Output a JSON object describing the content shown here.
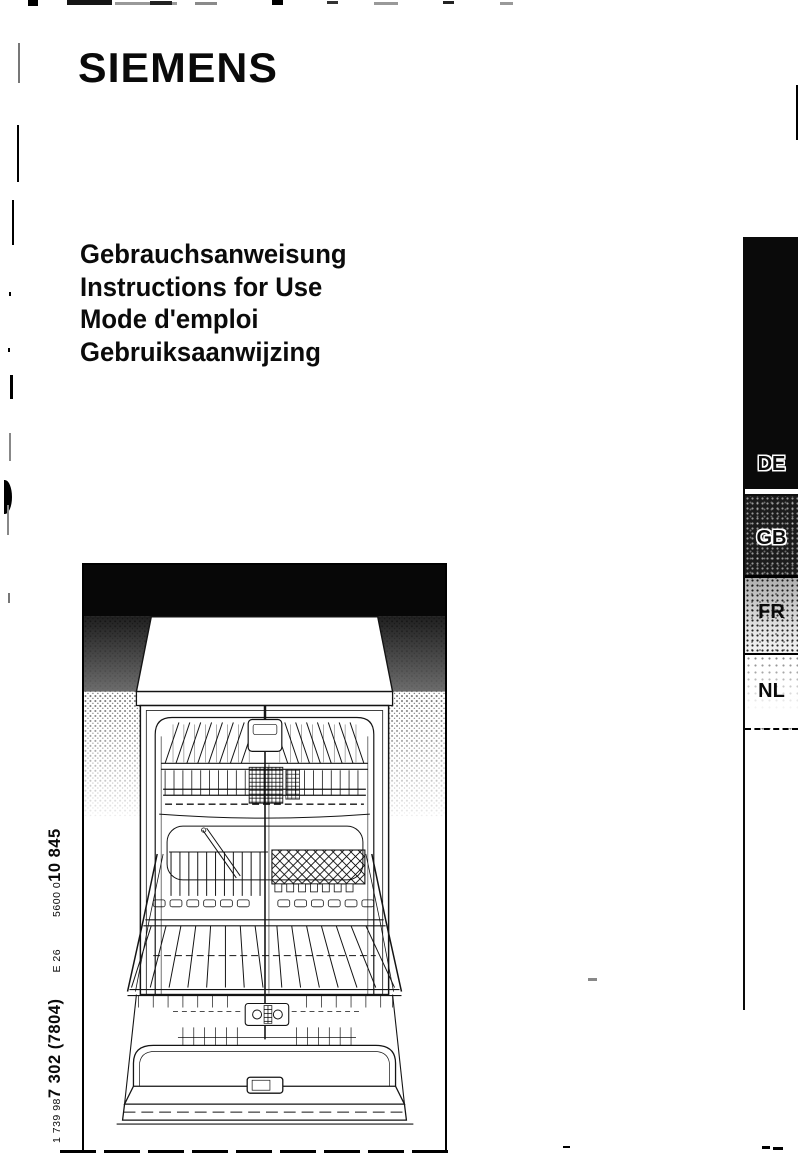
{
  "doc": {
    "brand": "SIEMENS",
    "title_lines": [
      "Gebrauchsanweisung",
      "Instructions for Use",
      "Mode d'emploi",
      "Gebruiksaanwijzing"
    ]
  },
  "tabs": {
    "de": "DE",
    "gb": "GB",
    "fr": "FR",
    "nl": "NL"
  },
  "spine": {
    "order_small": "1 739 98",
    "order_large": "7 302 (7804)",
    "edition": "E 26",
    "material_small": "5600 0",
    "material_large": "10 845"
  },
  "illustration": {
    "subject": "Open dishwasher with upper and lower baskets, line drawing"
  },
  "colors": {
    "ink": "#000000",
    "paper": "#ffffff"
  }
}
